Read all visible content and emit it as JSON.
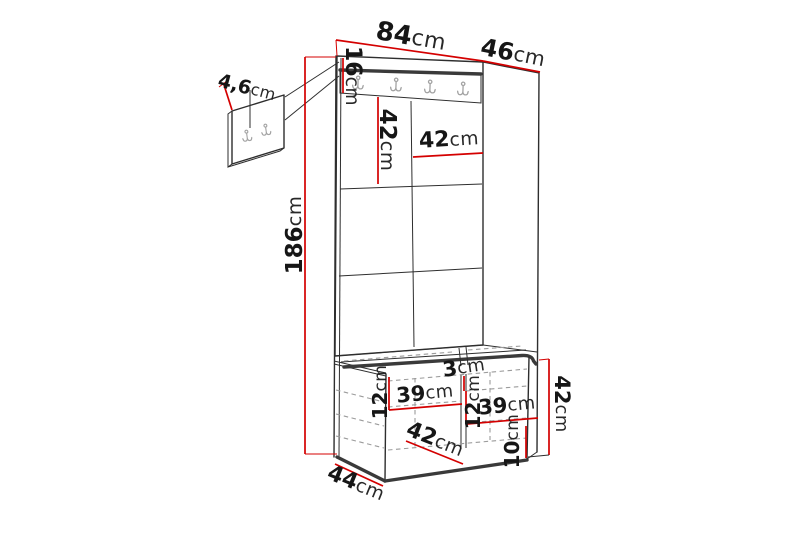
{
  "diagram": {
    "type": "furniture-dimension-diagram",
    "hooks": {
      "rail_hook_count": 4,
      "detail_panel_hook_count": 2
    },
    "dims": {
      "top_width": {
        "value": "84",
        "unit": "cm"
      },
      "top_depth": {
        "value": "46",
        "unit": "cm"
      },
      "rail_height": {
        "value": "16",
        "unit": "cm"
      },
      "tile_height": {
        "value": "42",
        "unit": "cm"
      },
      "tile_width": {
        "value": "42",
        "unit": "cm"
      },
      "total_height": {
        "value": "186",
        "unit": "cm"
      },
      "detail_thickness": {
        "value": "4,6",
        "unit": "cm"
      },
      "seat_gap": {
        "value": "3",
        "unit": "cm"
      },
      "left_compartment_height": {
        "value": "12",
        "unit": "cm"
      },
      "left_compartment_width": {
        "value": "39",
        "unit": "cm"
      },
      "right_compartment_height": {
        "value": "12",
        "unit": "cm"
      },
      "right_compartment_width": {
        "value": "39",
        "unit": "cm"
      },
      "bench_inner_depth": {
        "value": "42",
        "unit": "cm"
      },
      "bottom_clearance": {
        "value": "10",
        "unit": "cm"
      },
      "bench_height": {
        "value": "42",
        "unit": "cm"
      },
      "bench_depth": {
        "value": "44",
        "unit": "cm"
      }
    },
    "colors": {
      "dimension": "#d40000",
      "outline": "#2e2e2e",
      "hidden": "#9b9b9b",
      "hook": "#a3a3a3"
    }
  }
}
